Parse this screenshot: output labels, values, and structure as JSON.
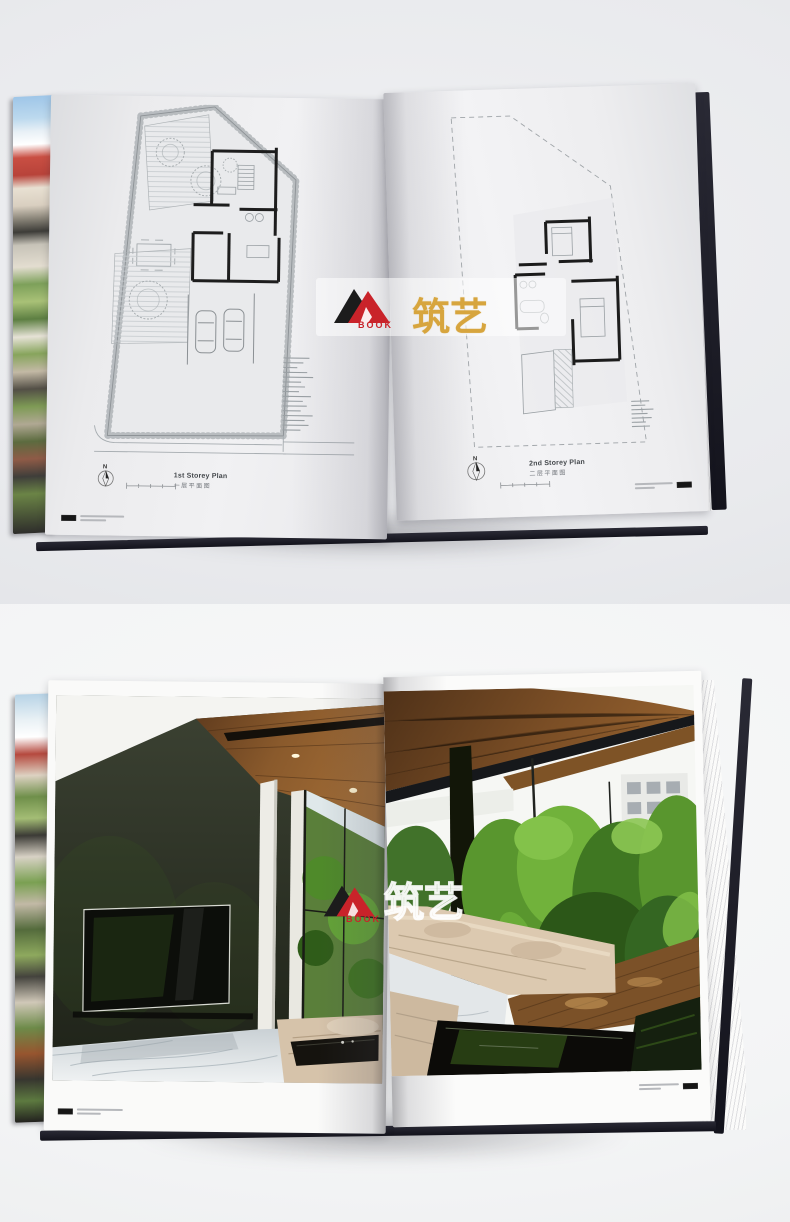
{
  "scene": {
    "top_description": "Open hardcover book photographed on grey surface showing two architectural floor plan pages",
    "bottom_description": "Open hardcover book photographed on white surface showing a full-bleed interior photograph spread"
  },
  "top_photo": {
    "left_page": {
      "caption_en": "1st Storey Plan",
      "caption_zh": "一层平面图",
      "north_label": "N"
    },
    "right_page": {
      "caption_en": "2nd Storey Plan",
      "caption_zh": "二层平面图",
      "north_label": "N"
    }
  },
  "watermark": {
    "book_label": "BOOK",
    "brand_zh": "筑艺"
  },
  "colors": {
    "logo_black": "#1c1c1c",
    "logo_red": "#c9232a",
    "brand_gold": "#d7a53e",
    "cover_dark": "#1c1c26",
    "page_grey": "#ececee",
    "wood_ceiling": "#8a5a2c",
    "plant_green": "#5f9e33",
    "sofa_cream": "#d8c5ac",
    "marble": "#e7eaec"
  }
}
